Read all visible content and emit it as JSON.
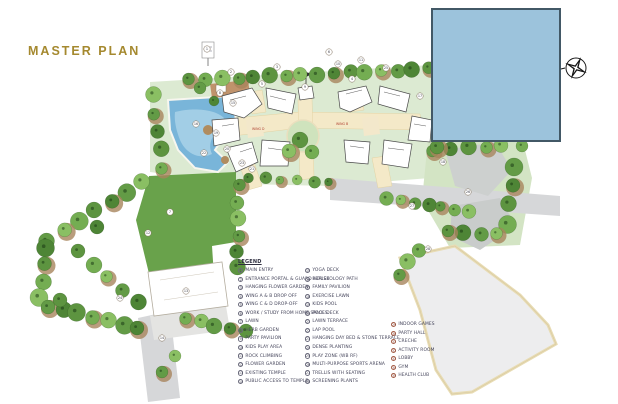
{
  "title": "MASTER PLAN",
  "colors": {
    "title_gold": "#a5892f",
    "cover_box_fill": "#9cc3dc",
    "cover_box_border": "#425866"
  },
  "legend": {
    "heading": "LEGEND",
    "columns": [
      {
        "marker_style": "dark",
        "items": [
          {
            "num": "1",
            "label": "MAIN ENTRY"
          },
          {
            "num": "2",
            "label": "ENTRANCE PORTAL & GUARD HOUSE"
          },
          {
            "num": "3",
            "label": "HANGING FLOWER GARDEN"
          },
          {
            "num": "4",
            "label": "WING A & B DROP OFF"
          },
          {
            "num": "5",
            "label": "WING C & D DROP-OFF"
          },
          {
            "num": "6",
            "label": "WORK / STUDY FROM HOME SPACES"
          },
          {
            "num": "7",
            "label": "LAWN"
          },
          {
            "num": "8",
            "label": "HERB GARDEN"
          },
          {
            "num": "9",
            "label": "PARTY PAVILION"
          },
          {
            "num": "10",
            "label": "KIDS PLAY AREA"
          },
          {
            "num": "11",
            "label": "ROCK CLIMBING"
          },
          {
            "num": "12",
            "label": "FLOWER GARDEN"
          },
          {
            "num": "13",
            "label": "EXISTING TEMPLE"
          },
          {
            "num": "14",
            "label": "PUBLIC ACCESS TO TEMPLE"
          }
        ]
      },
      {
        "marker_style": "dark",
        "items": [
          {
            "num": "15",
            "label": "YOGA DECK"
          },
          {
            "num": "16",
            "label": "REFLEXOLOGY PATH"
          },
          {
            "num": "17",
            "label": "FAMILY PAVILION"
          },
          {
            "num": "18",
            "label": "EXERCISE LAWN"
          },
          {
            "num": "19",
            "label": "KIDS POOL"
          },
          {
            "num": "20",
            "label": "POOL DECK"
          },
          {
            "num": "21",
            "label": "LAWN TERRACE"
          },
          {
            "num": "22",
            "label": "LAP POOL"
          },
          {
            "num": "23",
            "label": "HANGING DAY BED & STONE TERRACE"
          },
          {
            "num": "24",
            "label": "DENSE PLANTING"
          },
          {
            "num": "25",
            "label": "PLAY ZONE (WB RF)"
          },
          {
            "num": "26",
            "label": "MULTI-PURPOSE SPORTS ARENA"
          },
          {
            "num": "27",
            "label": "TRELLIS WITH SEATING"
          },
          {
            "num": "28",
            "label": "SCREENING PLANTS"
          }
        ]
      },
      {
        "marker_style": "red",
        "items": [
          {
            "num": "29",
            "label": "INDOOR GAMES"
          },
          {
            "num": "30",
            "label": "PARTY HALL"
          },
          {
            "num": "31",
            "label": "CRECHE"
          },
          {
            "num": "32",
            "label": "ACTIVITY ROOM"
          },
          {
            "num": "33",
            "label": "LOBBY"
          },
          {
            "num": "34",
            "label": "GYM"
          },
          {
            "num": "35",
            "label": "HEALTH CLUB"
          }
        ]
      }
    ]
  },
  "plan": {
    "wing_labels": [
      {
        "text": "WING D",
        "x": 252,
        "y": 130
      },
      {
        "text": "WING B",
        "x": 336,
        "y": 125
      }
    ],
    "markers": [
      {
        "n": "1",
        "x": 207,
        "y": 49
      },
      {
        "n": "2",
        "x": 231,
        "y": 72
      },
      {
        "n": "3",
        "x": 277,
        "y": 67
      },
      {
        "n": "4",
        "x": 352,
        "y": 79
      },
      {
        "n": "5",
        "x": 262,
        "y": 84
      },
      {
        "n": "6",
        "x": 329,
        "y": 52
      },
      {
        "n": "7",
        "x": 170,
        "y": 212
      },
      {
        "n": "8",
        "x": 220,
        "y": 93
      },
      {
        "n": "9",
        "x": 305,
        "y": 87
      },
      {
        "n": "10",
        "x": 338,
        "y": 64
      },
      {
        "n": "11",
        "x": 361,
        "y": 60
      },
      {
        "n": "12",
        "x": 148,
        "y": 233
      },
      {
        "n": "13",
        "x": 186,
        "y": 291
      },
      {
        "n": "14",
        "x": 162,
        "y": 338
      },
      {
        "n": "15",
        "x": 233,
        "y": 103
      },
      {
        "n": "16",
        "x": 196,
        "y": 124
      },
      {
        "n": "17",
        "x": 420,
        "y": 96
      },
      {
        "n": "18",
        "x": 443,
        "y": 162
      },
      {
        "n": "19",
        "x": 216,
        "y": 133
      },
      {
        "n": "20",
        "x": 227,
        "y": 149
      },
      {
        "n": "21",
        "x": 252,
        "y": 169
      },
      {
        "n": "22",
        "x": 204,
        "y": 153
      },
      {
        "n": "23",
        "x": 242,
        "y": 163
      },
      {
        "n": "24",
        "x": 120,
        "y": 298
      },
      {
        "n": "25",
        "x": 386,
        "y": 68
      },
      {
        "n": "26",
        "x": 468,
        "y": 192
      },
      {
        "n": "27",
        "x": 412,
        "y": 206
      },
      {
        "n": "28",
        "x": 428,
        "y": 249
      }
    ]
  }
}
